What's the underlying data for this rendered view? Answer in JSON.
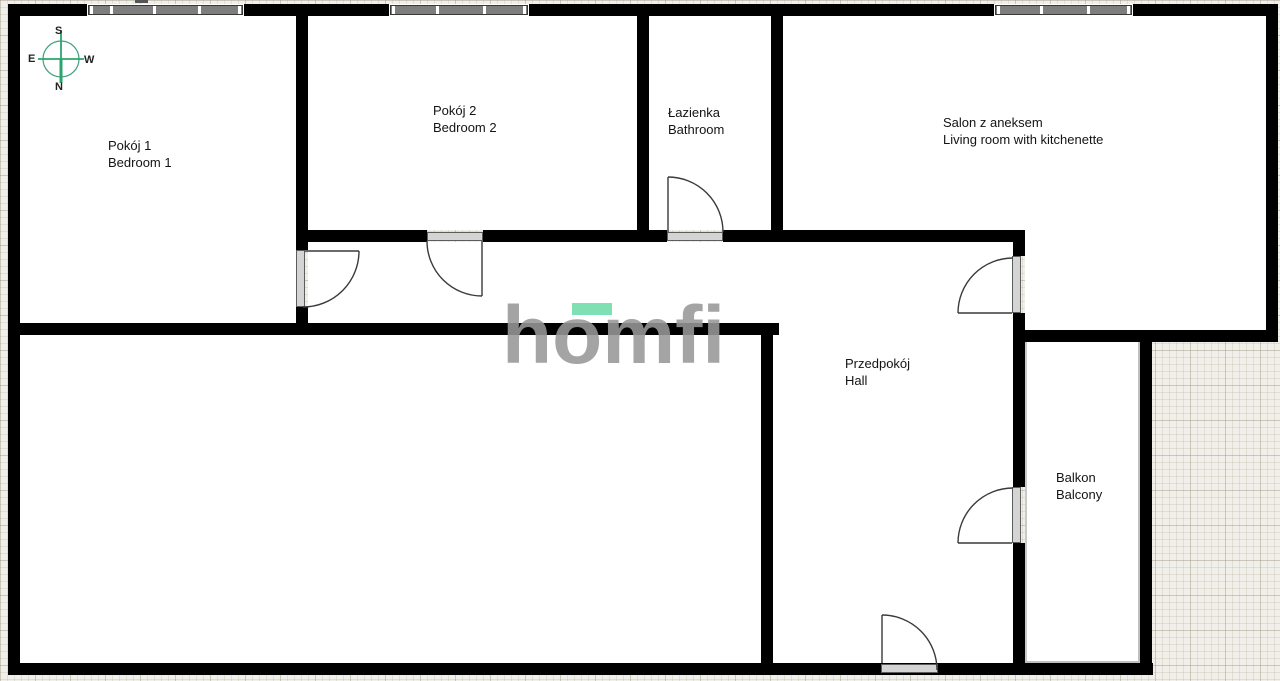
{
  "rooms": {
    "bedroom1": {
      "pl": "Pokój 1",
      "en": "Bedroom 1"
    },
    "bedroom2": {
      "pl": "Pokój 2",
      "en": "Bedroom 2"
    },
    "bathroom": {
      "pl": "Łazienka",
      "en": "Bathroom"
    },
    "living_room": {
      "pl": "Salon z aneksem",
      "en": "Living room with kitchenette"
    },
    "hall": {
      "pl": "Przedpokój",
      "en": "Hall"
    },
    "balcony": {
      "pl": "Balkon",
      "en": "Balcony"
    }
  },
  "compass": {
    "top": "S",
    "bottom": "N",
    "left": "E",
    "right": "W"
  },
  "watermark": {
    "text": "homfi",
    "segments": [
      "h",
      "o",
      "mfi"
    ],
    "accent_color": "#6EDCA9",
    "letter_color": "#989898"
  },
  "colors": {
    "wall": "#000000",
    "interior": "#FFFFFF",
    "exterior_paper": "#F1EFE9",
    "window_fill": "#7E7E7E",
    "door_line": "#3A3A3A",
    "compass_green": "#2CA46D"
  }
}
